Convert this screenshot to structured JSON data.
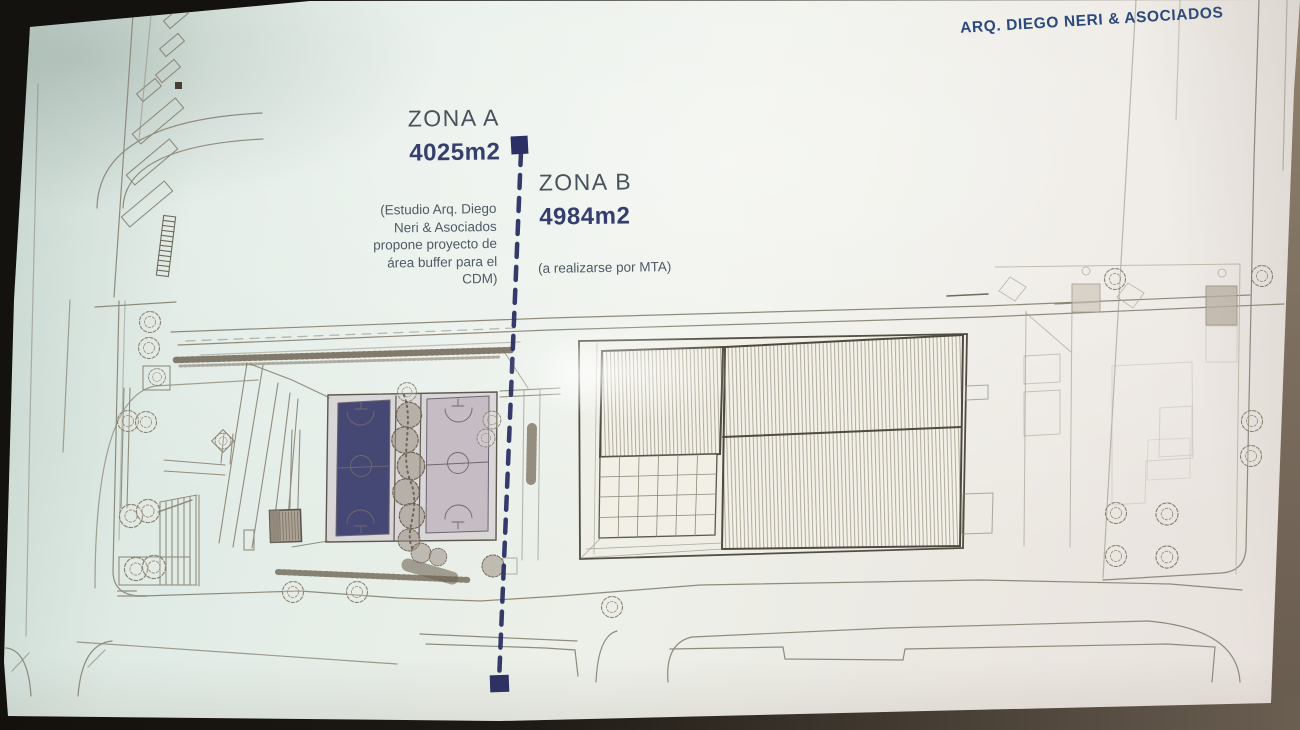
{
  "credit": "ARQ. DIEGO NERI & ASOCIADOS",
  "zone_a": {
    "title": "ZONA A",
    "area": "4025m2",
    "note": "(Estudio Arq. Diego\nNeri & Asociados\npropone proyecto de\nárea buffer para el\nCDM)"
  },
  "zone_b": {
    "title": "ZONA B",
    "area": "4984m2",
    "note": "(a realizarse por MTA)"
  },
  "colors": {
    "divider_navy": "#2b2f63",
    "zone_title": "#4a525c",
    "zone_area": "#353f6d",
    "note_text": "#4f5a66",
    "credit_blue": "#2b4a7b",
    "plan_line": "#8f8b7c",
    "plan_dark": "#4e4a3f",
    "court_fill": "#c2b9c1",
    "slide_bg": "#e9efe9"
  }
}
